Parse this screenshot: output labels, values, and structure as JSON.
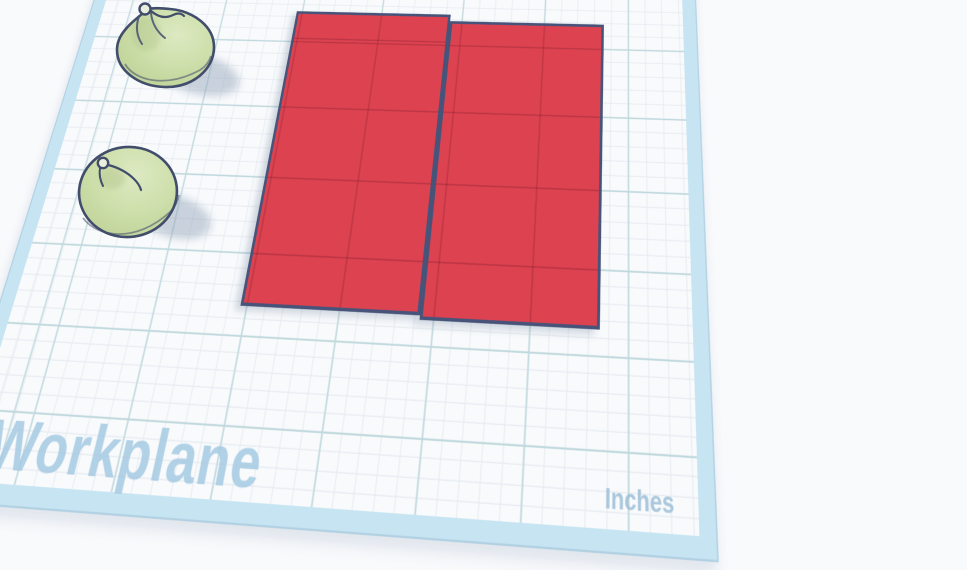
{
  "scene": {
    "workplane_label": "Workplane",
    "unit_label": "Inches"
  },
  "workplane": {
    "surface_color": "#f8fafc",
    "minor_grid_color": "#e3e8ee",
    "major_grid_color": "#c0d9dd",
    "edge_band_color": "#c6e4f2",
    "label_color": "#a4c9e2"
  },
  "objects": {
    "red_panels": {
      "description": "two flat red rectangular panels placed side by side on the workplane",
      "count": 2,
      "fill_color": "#dc4250",
      "outline_color": "#475379"
    },
    "green_spheres": {
      "description": "two light-green squashed spheres with curled loop stems",
      "count": 2,
      "fill_color": "#cddfaa",
      "outline_color": "#414d6b"
    }
  }
}
